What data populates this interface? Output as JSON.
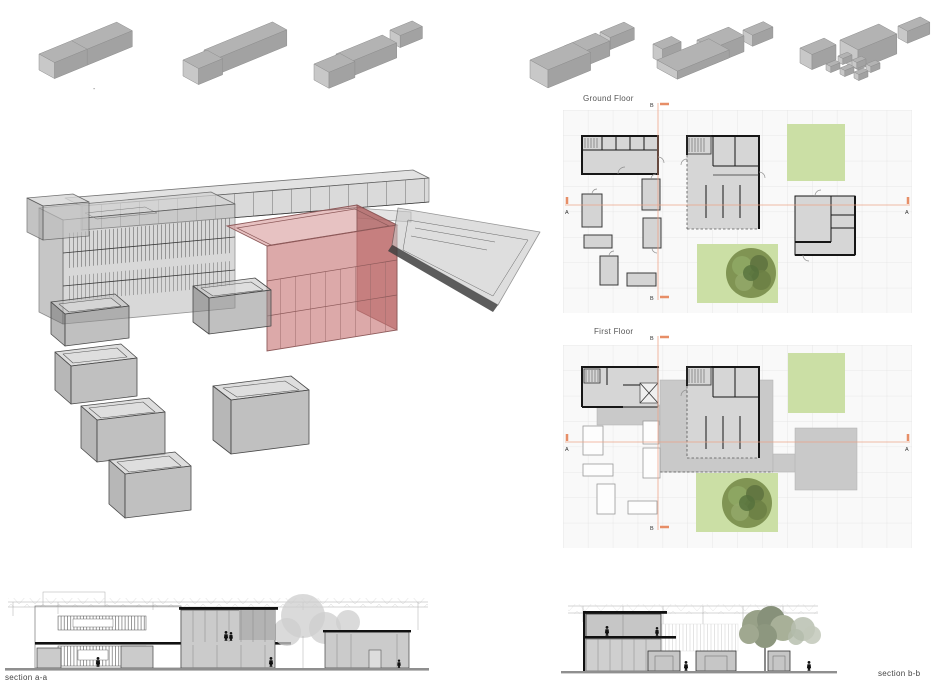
{
  "board": {
    "plan_ground_title": "Ground Floor",
    "plan_first_title": "First Floor",
    "section_a_label": "section a-a",
    "section_b_label": "section b-b",
    "marker_a": "A",
    "marker_b": "B",
    "stray_mark": "-"
  },
  "colors": {
    "highlight_red": "#c98f8f",
    "landscape_green": "#cbdfa5",
    "tree_green": "#7b8f4e",
    "section_line": "#eda084",
    "plan_fill": "#d6d6d6",
    "wall": "#161616",
    "massing_top": "#b3b3b3",
    "massing_front": "#a2a2a2",
    "massing_end": "#c8c8c8"
  }
}
